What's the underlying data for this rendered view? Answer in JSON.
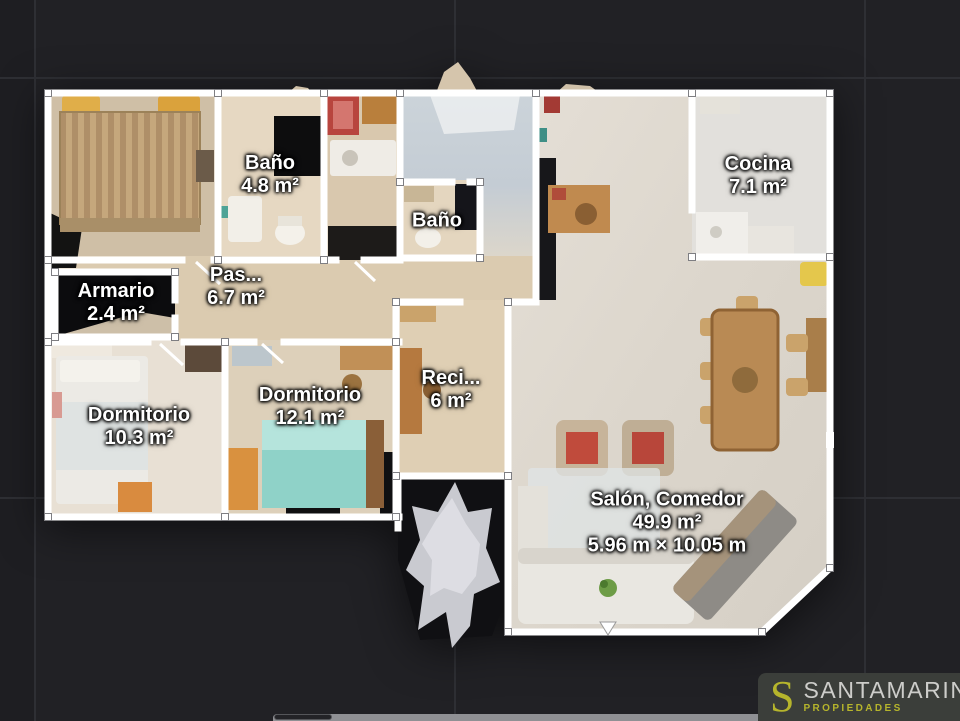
{
  "viewer": {
    "background_color": "#212125",
    "grid_color": "#2e2f34",
    "wall_color": "#ffffff"
  },
  "floor_plan": {
    "rooms": [
      {
        "id": "bano-1",
        "name": "Baño",
        "area": "4.8 m²",
        "dimensions": "",
        "label_x": 270,
        "label_y": 175
      },
      {
        "id": "bano-2",
        "name": "Baño",
        "area": "",
        "dimensions": "",
        "label_x": 437,
        "label_y": 221
      },
      {
        "id": "cocina",
        "name": "Cocina",
        "area": "7.1 m²",
        "dimensions": "",
        "label_x": 758,
        "label_y": 176
      },
      {
        "id": "armario",
        "name": "Armario",
        "area": "2.4 m²",
        "dimensions": "",
        "label_x": 116,
        "label_y": 303
      },
      {
        "id": "pasillo",
        "name": "Pas...",
        "area": "6.7 m²",
        "dimensions": "",
        "label_x": 236,
        "label_y": 287
      },
      {
        "id": "dormitorio-1",
        "name": "Dormitorio",
        "area": "10.3 m²",
        "dimensions": "",
        "label_x": 139,
        "label_y": 427
      },
      {
        "id": "dormitorio-2",
        "name": "Dormitorio",
        "area": "12.1 m²",
        "dimensions": "",
        "label_x": 310,
        "label_y": 407
      },
      {
        "id": "recibidor",
        "name": "Reci...",
        "area": "6 m²",
        "dimensions": "",
        "label_x": 451,
        "label_y": 390
      },
      {
        "id": "salon",
        "name": "Salón, Comedor",
        "area": "49.9 m²",
        "dimensions": "5.96 m × 10.05 m",
        "label_x": 667,
        "label_y": 523
      }
    ]
  },
  "logo": {
    "initial": "S",
    "name": "SANTAMARINA",
    "tagline": "PROPIEDADES",
    "accent_color": "#b6b52c",
    "name_color": "#cdcdca",
    "background": "#3b3e3a"
  }
}
